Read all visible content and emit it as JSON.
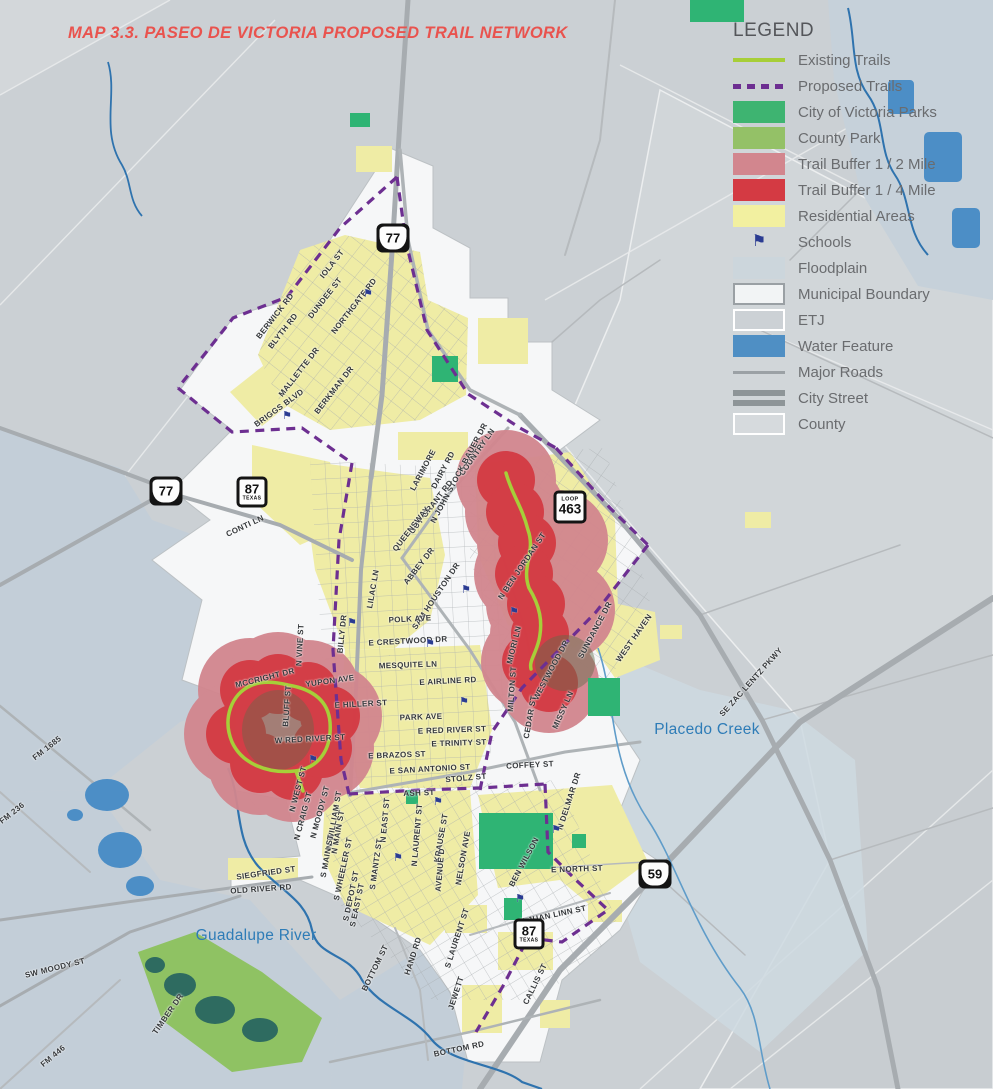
{
  "title": "MAP 3.3. PASEO DE VICTORIA PROPOSED TRAIL NETWORK",
  "legend": {
    "title": "LEGEND",
    "items": [
      {
        "label": "Existing Trails",
        "swatch": "line-solid",
        "color": "#a7ce38"
      },
      {
        "label": "Proposed Trails",
        "swatch": "line-dashed",
        "color": "#6d2e91"
      },
      {
        "label": "City of Victoria Parks",
        "swatch": "fill",
        "color": "#3eb471"
      },
      {
        "label": "County Park",
        "swatch": "fill",
        "color": "#94c167"
      },
      {
        "label": "Trail Buffer 1 / 2 Mile",
        "swatch": "fill",
        "color": "#d2868e"
      },
      {
        "label": "Trail Buffer 1 / 4 Mile",
        "swatch": "fill",
        "color": "#d43a43"
      },
      {
        "label": "Residential Areas",
        "swatch": "fill",
        "color": "#f2f0a0"
      },
      {
        "label": "Schools",
        "swatch": "flag",
        "color": "#2b3c92"
      },
      {
        "label": "Floodplain",
        "swatch": "fill",
        "color": "#ccd6dc"
      },
      {
        "label": "Municipal Boundary",
        "swatch": "fill-border",
        "color": "#f2f4f5",
        "border": "#9aa0a4"
      },
      {
        "label": "ETJ",
        "swatch": "fill-border",
        "color": "#ccd1d5",
        "border": "#ffffff"
      },
      {
        "label": "Water Feature",
        "swatch": "fill",
        "color": "#4f8fc4"
      },
      {
        "label": "Major Roads",
        "swatch": "line-road",
        "color": "#9ba1a5"
      },
      {
        "label": "City Street",
        "swatch": "line-street",
        "color": "#8e9598"
      },
      {
        "label": "County",
        "swatch": "fill-border",
        "color": "#d6dadd",
        "border": "#ffffff"
      }
    ]
  },
  "shields": [
    {
      "type": "us",
      "number": "77",
      "x": 393,
      "y": 238
    },
    {
      "type": "us",
      "number": "77",
      "x": 166,
      "y": 491
    },
    {
      "type": "state",
      "number": "87",
      "sub": "TEXAS",
      "x": 252,
      "y": 492
    },
    {
      "type": "loop",
      "number": "463",
      "sub": "LOOP",
      "x": 570,
      "y": 507
    },
    {
      "type": "us",
      "number": "59",
      "x": 655,
      "y": 874
    },
    {
      "type": "state",
      "number": "87",
      "sub": "TEXAS",
      "x": 529,
      "y": 934
    }
  ],
  "water_labels": [
    {
      "text": "Guadalupe River",
      "x": 256,
      "y": 936
    },
    {
      "text": "Placedo Creek",
      "x": 707,
      "y": 730
    }
  ],
  "street_labels": [
    {
      "text": "IOLA ST",
      "x": 332,
      "y": 264,
      "rot": -52
    },
    {
      "text": "DUNDEE ST",
      "x": 325,
      "y": 298,
      "rot": -52
    },
    {
      "text": "NORTHGATE RD",
      "x": 354,
      "y": 306,
      "rot": -52
    },
    {
      "text": "BERWICK RD",
      "x": 275,
      "y": 316,
      "rot": -52
    },
    {
      "text": "BLYTH RD",
      "x": 283,
      "y": 331,
      "rot": -52
    },
    {
      "text": "MALLETTE DR",
      "x": 299,
      "y": 372,
      "rot": -52
    },
    {
      "text": "BERKMAN DR",
      "x": 334,
      "y": 390,
      "rot": -52
    },
    {
      "text": "BRIGGS BLVD",
      "x": 279,
      "y": 408,
      "rot": -36
    },
    {
      "text": "COUNTRY LN",
      "x": 477,
      "y": 452,
      "rot": -55
    },
    {
      "text": "N JOHN STOCK BAUER DR",
      "x": 459,
      "y": 473,
      "rot": -62
    },
    {
      "text": "DAIRY RD",
      "x": 443,
      "y": 470,
      "rot": -62
    },
    {
      "text": "LARIMORE",
      "x": 423,
      "y": 470,
      "rot": -62
    },
    {
      "text": "GUY GRANT RD",
      "x": 431,
      "y": 507,
      "rot": -52
    },
    {
      "text": "QUEENSWAY",
      "x": 411,
      "y": 529,
      "rot": -52
    },
    {
      "text": "CONTI LN",
      "x": 245,
      "y": 526,
      "rot": -25
    },
    {
      "text": "ABBEY DR",
      "x": 419,
      "y": 566,
      "rot": -52
    },
    {
      "text": "SAM HOUSTON DR",
      "x": 436,
      "y": 596,
      "rot": -56
    },
    {
      "text": "LILAC LN",
      "x": 373,
      "y": 589,
      "rot": -80
    },
    {
      "text": "POLK AVE",
      "x": 410,
      "y": 619,
      "rot": -3
    },
    {
      "text": "E CRESTWOOD DR",
      "x": 408,
      "y": 641,
      "rot": -3
    },
    {
      "text": "MESQUITE LN",
      "x": 408,
      "y": 665,
      "rot": -2
    },
    {
      "text": "E AIRLINE RD",
      "x": 448,
      "y": 681,
      "rot": -3
    },
    {
      "text": "BILLY DR",
      "x": 342,
      "y": 634,
      "rot": -84
    },
    {
      "text": "N VINE ST",
      "x": 300,
      "y": 645,
      "rot": -87
    },
    {
      "text": "N BEN JORDAN ST",
      "x": 522,
      "y": 566,
      "rot": -56
    },
    {
      "text": "MIORI LN",
      "x": 514,
      "y": 645,
      "rot": -76
    },
    {
      "text": "SUNDANCE DR",
      "x": 595,
      "y": 630,
      "rot": -62
    },
    {
      "text": "WEST HAVEN",
      "x": 634,
      "y": 638,
      "rot": -55
    },
    {
      "text": "WESTWOOD DR",
      "x": 551,
      "y": 670,
      "rot": -62
    },
    {
      "text": "MILTON ST",
      "x": 512,
      "y": 689,
      "rot": -86
    },
    {
      "text": "CEDAR ST",
      "x": 530,
      "y": 717,
      "rot": -80
    },
    {
      "text": "MISSY LN",
      "x": 563,
      "y": 710,
      "rot": -66
    },
    {
      "text": "SE ZAC LENTZ PKWY",
      "x": 751,
      "y": 682,
      "rot": -48
    },
    {
      "text": "MCCRIGHT DR",
      "x": 265,
      "y": 678,
      "rot": -14
    },
    {
      "text": "BLUFF ST",
      "x": 287,
      "y": 706,
      "rot": -86
    },
    {
      "text": "YUPON AVE",
      "x": 330,
      "y": 681,
      "rot": -8
    },
    {
      "text": "E HILLER ST",
      "x": 361,
      "y": 704,
      "rot": -3
    },
    {
      "text": "W RED RIVER ST",
      "x": 310,
      "y": 739,
      "rot": -3
    },
    {
      "text": "PARK AVE",
      "x": 421,
      "y": 717,
      "rot": -2
    },
    {
      "text": "E RED RIVER ST",
      "x": 452,
      "y": 730,
      "rot": -2
    },
    {
      "text": "E TRINITY ST",
      "x": 459,
      "y": 743,
      "rot": -2
    },
    {
      "text": "E BRAZOS ST",
      "x": 397,
      "y": 755,
      "rot": -2
    },
    {
      "text": "E SAN ANTONIO ST",
      "x": 430,
      "y": 769,
      "rot": -3
    },
    {
      "text": "STOLZ ST",
      "x": 466,
      "y": 778,
      "rot": -5
    },
    {
      "text": "COFFEY ST",
      "x": 530,
      "y": 765,
      "rot": -3
    },
    {
      "text": "ASH ST",
      "x": 419,
      "y": 793,
      "rot": -2
    },
    {
      "text": "N EAST ST",
      "x": 385,
      "y": 820,
      "rot": -85
    },
    {
      "text": "N LAURENT ST",
      "x": 417,
      "y": 835,
      "rot": -85
    },
    {
      "text": "KRAUSE ST",
      "x": 441,
      "y": 838,
      "rot": -80
    },
    {
      "text": "AVENUE D",
      "x": 440,
      "y": 870,
      "rot": -85
    },
    {
      "text": "NELSON AVE",
      "x": 463,
      "y": 858,
      "rot": -80
    },
    {
      "text": "BEN WILSON",
      "x": 524,
      "y": 862,
      "rot": -62
    },
    {
      "text": "E NORTH ST",
      "x": 577,
      "y": 869,
      "rot": -2
    },
    {
      "text": "N DELMAR DR",
      "x": 569,
      "y": 801,
      "rot": -72
    },
    {
      "text": "N WILLIAM ST",
      "x": 334,
      "y": 820,
      "rot": -80
    },
    {
      "text": "N MOODY ST",
      "x": 320,
      "y": 812,
      "rot": -75
    },
    {
      "text": "N CRAIG ST",
      "x": 303,
      "y": 816,
      "rot": -75
    },
    {
      "text": "N WEST ST",
      "x": 298,
      "y": 789,
      "rot": -75
    },
    {
      "text": "N MAIN ST",
      "x": 338,
      "y": 832,
      "rot": -80
    },
    {
      "text": "S MAIN ST",
      "x": 327,
      "y": 856,
      "rot": -80
    },
    {
      "text": "S WHEELER ST",
      "x": 343,
      "y": 869,
      "rot": -78
    },
    {
      "text": "S DEPOT ST",
      "x": 351,
      "y": 896,
      "rot": -78
    },
    {
      "text": "S EAST ST",
      "x": 357,
      "y": 905,
      "rot": -78
    },
    {
      "text": "S MANTZ ST",
      "x": 376,
      "y": 864,
      "rot": -82
    },
    {
      "text": "SIEGFRIED ST",
      "x": 266,
      "y": 873,
      "rot": -8
    },
    {
      "text": "OLD RIVER RD",
      "x": 261,
      "y": 889,
      "rot": -4
    },
    {
      "text": "HAND RD",
      "x": 413,
      "y": 956,
      "rot": -72
    },
    {
      "text": "BOTTOM ST",
      "x": 375,
      "y": 968,
      "rot": -64
    },
    {
      "text": "S LAURENT ST",
      "x": 457,
      "y": 938,
      "rot": -72
    },
    {
      "text": "JEWETT",
      "x": 456,
      "y": 993,
      "rot": -72
    },
    {
      "text": "CALLIS ST",
      "x": 535,
      "y": 984,
      "rot": -64
    },
    {
      "text": "BOTTOM RD",
      "x": 459,
      "y": 1049,
      "rot": -12
    },
    {
      "text": "E JUAN LINN ST",
      "x": 553,
      "y": 915,
      "rot": -12
    },
    {
      "text": "FM 1685",
      "x": 47,
      "y": 748,
      "rot": -38
    },
    {
      "text": "FM 236",
      "x": 12,
      "y": 813,
      "rot": -38
    },
    {
      "text": "SW MOODY ST",
      "x": 55,
      "y": 968,
      "rot": -14
    },
    {
      "text": "FM 446",
      "x": 53,
      "y": 1056,
      "rot": -40
    },
    {
      "text": "TIMBER DR",
      "x": 168,
      "y": 1014,
      "rot": -55
    }
  ],
  "schools": [
    {
      "x": 466,
      "y": 594
    },
    {
      "x": 430,
      "y": 648
    },
    {
      "x": 352,
      "y": 627
    },
    {
      "x": 514,
      "y": 616
    },
    {
      "x": 464,
      "y": 706
    },
    {
      "x": 313,
      "y": 764
    },
    {
      "x": 438,
      "y": 806
    },
    {
      "x": 398,
      "y": 862
    },
    {
      "x": 520,
      "y": 903
    },
    {
      "x": 556,
      "y": 834
    },
    {
      "x": 368,
      "y": 298
    },
    {
      "x": 287,
      "y": 420
    }
  ],
  "colors": {
    "title_red": "#e9534e",
    "existing_trail": "#a7ce38",
    "proposed_trail": "#6d2e91",
    "city_park": "#3eb471",
    "county_park": "#94c167",
    "buffer_half": "#d2868e",
    "buffer_quarter": "#d43a43",
    "residential": "#f2f0a0",
    "floodplain": "#c3ced8",
    "water": "#4f8fc4",
    "etj": "#cbd0d4",
    "municipal": "#f6f7f8",
    "major_road": "#a7acb0"
  }
}
